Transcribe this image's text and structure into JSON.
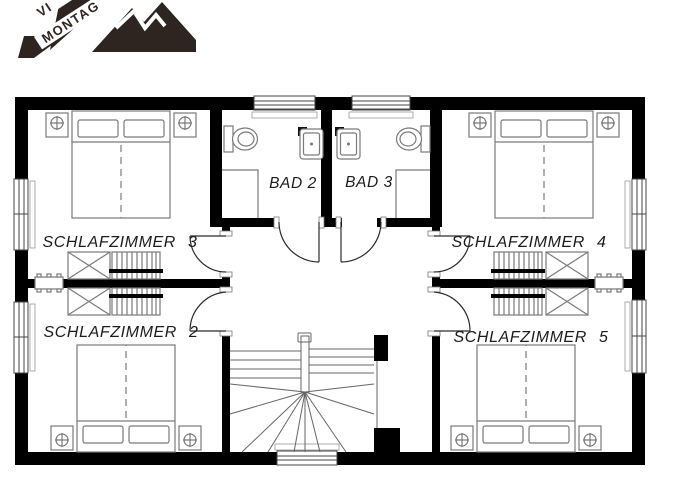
{
  "logo": {
    "line1": "VI",
    "line2": "MONTAG",
    "color": "#2e2420"
  },
  "plan": {
    "background": "#ffffff",
    "wall_color": "#000000",
    "furniture_line_color": "#7a7a7a",
    "label_color": "#1b1b1b",
    "rooms": {
      "schlafzimmer3": {
        "label": "SCHLAFZIMMER 3"
      },
      "schlafzimmer4": {
        "label": "SCHLAFZIMMER 4"
      },
      "schlafzimmer2": {
        "label": "SCHLAFZIMMER 2"
      },
      "schlafzimmer5": {
        "label": "SCHLAFZIMMER 5"
      },
      "bad2": {
        "label": "BAD 2"
      },
      "bad3": {
        "label": "BAD 3"
      }
    }
  }
}
